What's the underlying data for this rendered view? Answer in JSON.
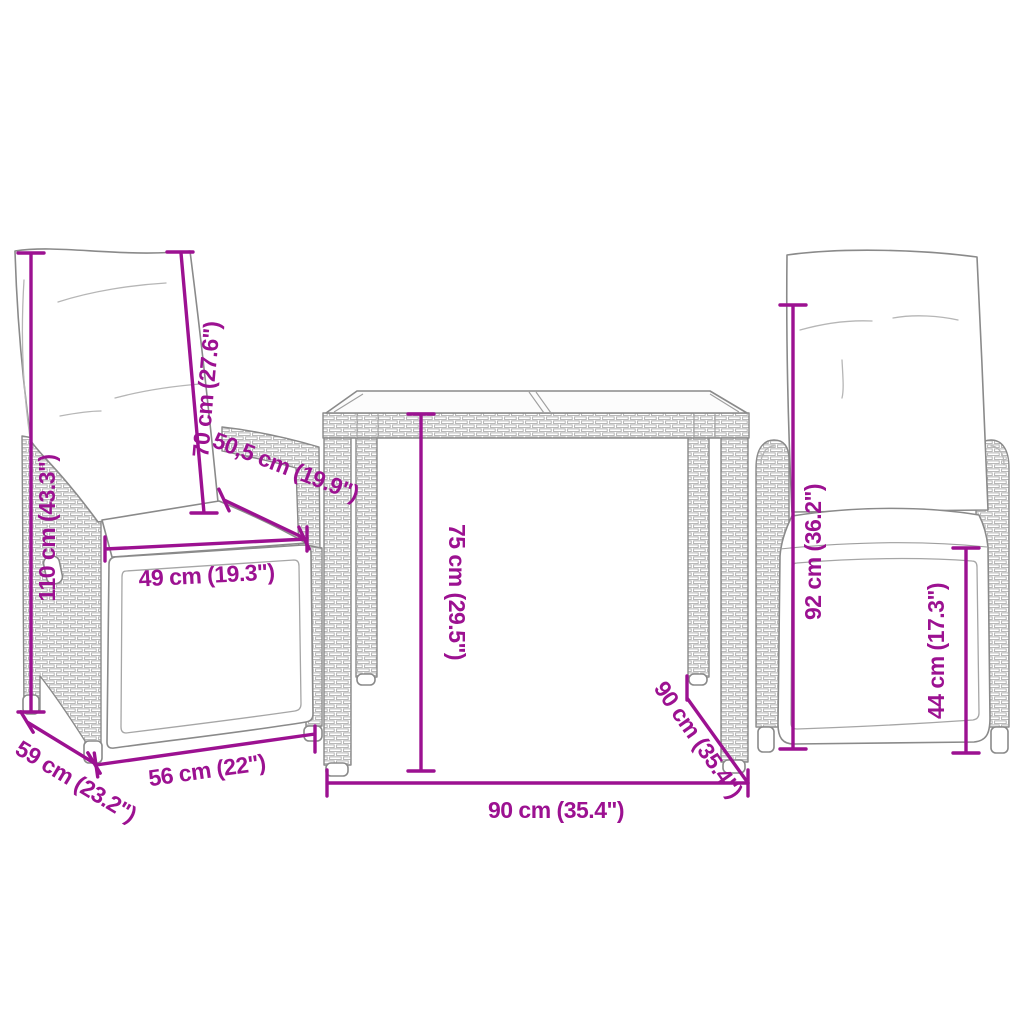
{
  "colors": {
    "dimension": "#9c1191",
    "outline": "#8a8a8a",
    "background": "#ffffff"
  },
  "diagram": {
    "product": "3-piece bistro set dimension diagram",
    "left_chair": {
      "height": "110 cm (43.3\")",
      "backrest": "70 cm (27.6\")",
      "seat_depth": "50,5 cm (19.9\")",
      "seat_width": "49 cm (19.3\")",
      "base_width": "56 cm (22\")",
      "base_depth": "59 cm (23.2\")"
    },
    "table": {
      "height": "75 cm (29.5\")",
      "width": "90 cm (35.4\")",
      "depth": "90 cm (35.4\")"
    },
    "right_chair": {
      "height": "92 cm (36.2\")",
      "seat_height": "44 cm (17.3\")"
    }
  }
}
